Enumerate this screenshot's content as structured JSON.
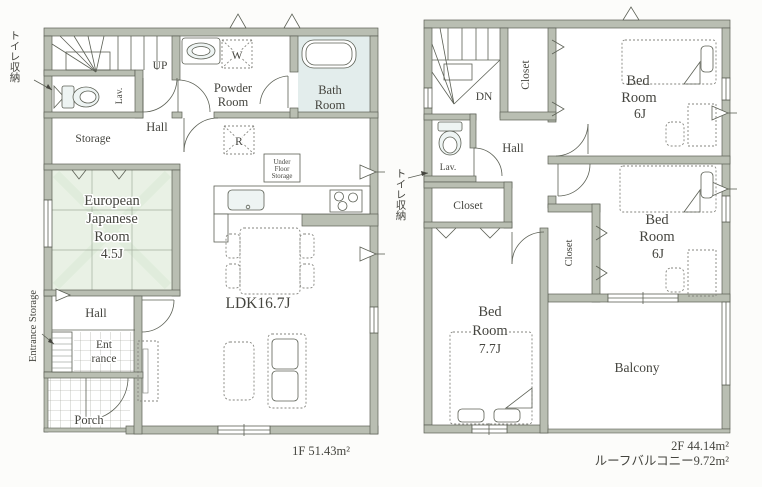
{
  "colors": {
    "wall": "#b9beb2",
    "wall_line": "#5c6055",
    "tatami": "#e9f1e5",
    "bath": "#e3edec",
    "fixture": "#eef4f3",
    "floor": "#fcfcfa",
    "text": "#45453f",
    "dash": "#85857f"
  },
  "floor1": {
    "labels": {
      "toilet_storage": "トイレ収納",
      "up": "UP",
      "lav": "Lav.",
      "hall_upper": "Hall",
      "storage": "Storage",
      "powder1": "Powder",
      "powder2": "Room",
      "washer": "W",
      "bath1": "Bath",
      "bath2": "Room",
      "fridge": "R",
      "ufs1": "Under",
      "ufs2": "Floor",
      "ufs3": "Storage",
      "tatami1": "European",
      "tatami2": "Japanese",
      "tatami3": "Room",
      "tatami4": "4.5J",
      "ldk": "LDK16.7J",
      "hall_lower": "Hall",
      "ent1": "Ent",
      "ent2": "rance",
      "entrance_storage": "Entrance Storage",
      "porch": "Porch",
      "area": "1F 51.43m²"
    }
  },
  "floor2": {
    "labels": {
      "dn": "DN",
      "closet_top": "Closet",
      "bed1_1": "Bed",
      "bed1_2": "Room",
      "bed1_3": "6J",
      "lav": "Lav.",
      "hall": "Hall",
      "toilet_storage": "トイレ収納",
      "closet_mid": "Closet",
      "closet_right": "Closet",
      "bed2_1": "Bed",
      "bed2_2": "Room",
      "bed2_3": "6J",
      "bed3_1": "Bed",
      "bed3_2": "Room",
      "bed3_3": "7.7J",
      "balcony": "Balcony",
      "area": "2F 44.14m²",
      "roof_balcony": "ルーフバルコニー9.72m²"
    }
  }
}
